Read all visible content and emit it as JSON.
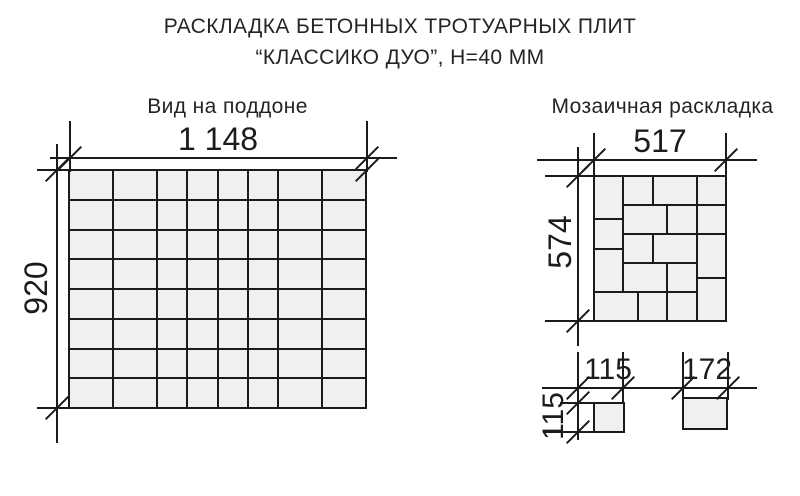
{
  "title": {
    "line1": "РАСКЛАДКА БЕТОННЫХ ТРОТУАРНЫХ ПЛИТ",
    "line2": "“КЛАССИКО ДУО”, Н=40 ММ"
  },
  "pallet_view": {
    "heading": "Вид на поддоне",
    "width_mm_label": "1 148",
    "height_mm_label": "920",
    "columns_mm": [
      172,
      172,
      115,
      115,
      115,
      115,
      172,
      172
    ],
    "rows": 8
  },
  "mosaic_view": {
    "heading": "Мозаичная раскладка",
    "width_mm_label": "517",
    "height_mm_label": "574",
    "module_width_mm": 517,
    "module_height_mm": 574,
    "tiles_mm": [
      [
        0,
        0,
        115,
        172
      ],
      [
        115,
        0,
        115,
        115
      ],
      [
        230,
        0,
        172,
        115
      ],
      [
        402,
        0,
        115,
        115
      ],
      [
        0,
        172,
        115,
        115
      ],
      [
        115,
        115,
        172,
        115
      ],
      [
        287,
        115,
        115,
        115
      ],
      [
        402,
        115,
        115,
        115
      ],
      [
        0,
        287,
        115,
        172
      ],
      [
        115,
        230,
        115,
        115
      ],
      [
        230,
        230,
        172,
        115
      ],
      [
        402,
        230,
        115,
        172
      ],
      [
        115,
        345,
        172,
        115
      ],
      [
        287,
        345,
        115,
        115
      ],
      [
        402,
        402,
        115,
        172
      ],
      [
        0,
        459,
        172,
        115
      ],
      [
        172,
        459,
        115,
        115
      ],
      [
        287,
        459,
        115,
        115
      ]
    ]
  },
  "tile_sizes": {
    "square_width_label": "115",
    "square_height_label": "115",
    "rect_width_label": "172"
  },
  "colors": {
    "line": "#1b1b1b",
    "tile_fill": "#f0f0ef",
    "background": "#ffffff",
    "text": "#242424"
  }
}
